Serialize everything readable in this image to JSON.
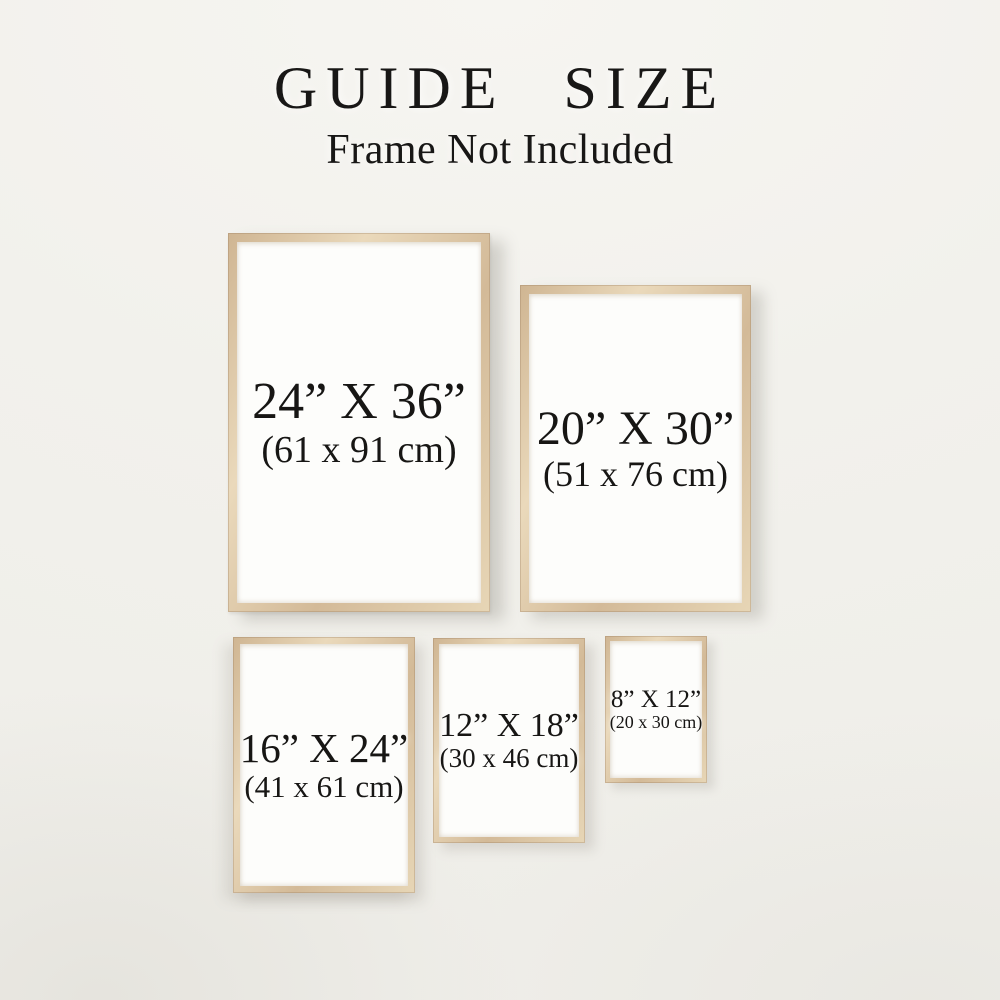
{
  "page": {
    "title": "GUIDE SIZE",
    "subtitle": "Frame Not Included"
  },
  "colors": {
    "background": "#f2f1ec",
    "frame_wood": "#d7c1a1",
    "frame_wood_highlight": "#ead9bb",
    "frame_wood_shadow": "#cfb592",
    "paper": "#fdfdfb",
    "text": "#171614"
  },
  "frames": [
    {
      "name": "24x36",
      "size_in": "24” X 36”",
      "size_cm": "(61 x 91 cm)"
    },
    {
      "name": "20x30",
      "size_in": "20” X 30”",
      "size_cm": "(51 x 76 cm)"
    },
    {
      "name": "16x24",
      "size_in": "16” X 24”",
      "size_cm": "(41 x 61 cm)"
    },
    {
      "name": "12x18",
      "size_in": "12” X 18”",
      "size_cm": "(30 x 46 cm)"
    },
    {
      "name": "8x12",
      "size_in": "8” X 12”",
      "size_cm": "(20 x 30 cm)"
    }
  ]
}
